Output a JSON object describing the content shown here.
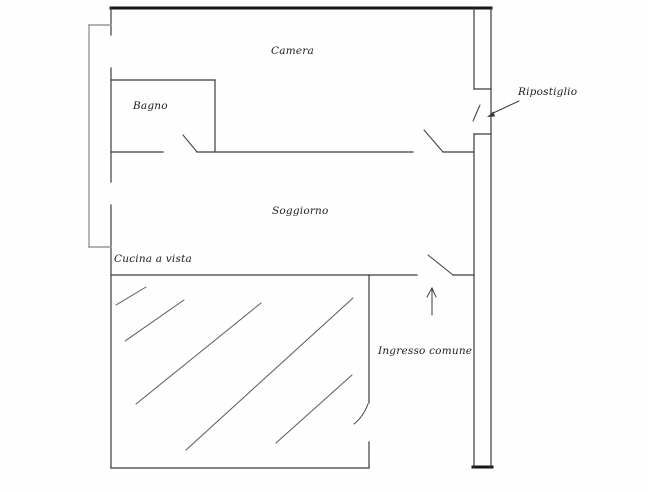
{
  "labels": {
    "camera": "Camera",
    "bagno": "Bagno",
    "soggiorno": "Soggiorno",
    "cucina": "Cucina a vista",
    "ingresso": "Ingresso comune",
    "ripostiglio": "Ripostiglio"
  },
  "colors": {
    "background": "#fefefe",
    "wall_thin": "#3c3c3c",
    "wall_thick": "#171717",
    "offset_line": "#989898",
    "hatch": "#5a5a5a",
    "arrow": "#3a3a3a",
    "text": "#1d1d1d"
  }
}
